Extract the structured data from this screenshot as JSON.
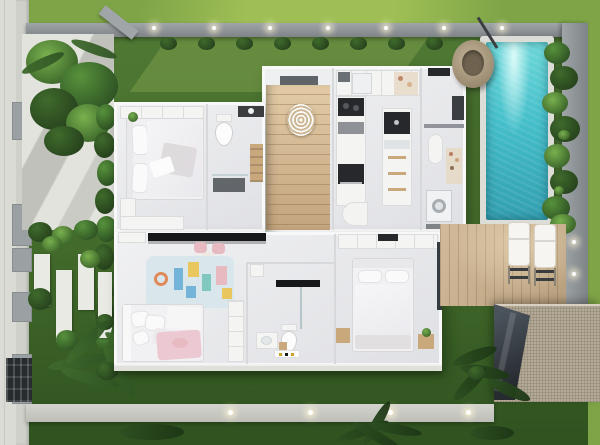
{
  "scene": {
    "type": "architectural-3d-floor-plan-render",
    "view": "top-down",
    "house": {
      "rooms": [
        {
          "name": "bedroom-1",
          "furniture": [
            "double-bed",
            "wardrobe",
            "tv-panel",
            "closet",
            "plant"
          ]
        },
        {
          "name": "ensuite-bathroom",
          "furniture": [
            "toilet",
            "dark-vanity",
            "ladder-shelf",
            "shower-mat",
            "glass-screen"
          ]
        },
        {
          "name": "staircase",
          "furniture": [
            "wood-steps",
            "spiral-pendant-light",
            "entry-door"
          ]
        },
        {
          "name": "kitchen",
          "furniture": [
            "upper-cabinets",
            "fridge",
            "pantry-shelf",
            "cooktop",
            "oven",
            "island-counter",
            "sink",
            "drawers",
            "round-table"
          ]
        },
        {
          "name": "laundry-room",
          "furniture": [
            "counter-rail",
            "capsule-table",
            "bottle-shelf",
            "washing-machine",
            "steel-unit"
          ]
        },
        {
          "name": "living-area",
          "furniture": [
            "media-console",
            "sideboard",
            "kids-chairs",
            "round-side-table"
          ]
        },
        {
          "name": "kids-bedroom",
          "furniture": [
            "play-rug",
            "kids-bed",
            "cabinet",
            "floor-cushion"
          ]
        },
        {
          "name": "bathroom-2",
          "furniture": [
            "rain-shower-bar",
            "glass-screen",
            "toilet",
            "vanity",
            "wood-stool",
            "bath-mat",
            "shelf-box"
          ]
        },
        {
          "name": "master-bedroom",
          "furniture": [
            "double-bed",
            "wardrobe",
            "nightstand-left",
            "nightstand-right",
            "sliding-glass-door"
          ]
        }
      ]
    },
    "outdoor": {
      "features": [
        "street-sidewalk",
        "left-boundary-wall",
        "wall-pillars",
        "driveway-gate",
        "entrance-gate-pillar",
        "concrete-walkway",
        "hedge-row",
        "shrub-row",
        "stepping-stone-slabs",
        "round-bushes",
        "palm-cluster-top-left",
        "palm-bottom-left",
        "lawn",
        "top-perimeter-wall",
        "wall-uplights",
        "swimming-pool",
        "pool-coping",
        "hanging-egg-chair",
        "poolside-bush-hedge",
        "right-boundary-wall",
        "timber-deck",
        "sun-lounger-1",
        "sun-lounger-2",
        "pergola-gravel-roof",
        "dark-glass-screen",
        "rear-path",
        "path-uplights",
        "garden-fronds",
        "grass-tufts"
      ]
    }
  },
  "palette": {
    "grass-bright": "#7ea447",
    "grass-light": "#a3c257",
    "lawn-top": "#4e7833",
    "lawn-mid": "#47702e",
    "lawn-dark": "#3a6026",
    "lawn-deep": "#2f5220",
    "sidewalk": "#dadbd5",
    "wall-panel": "#cfd0ca",
    "pillar-gray": "#9ba1a3",
    "perim-a": "#a0a5a8",
    "perim-b": "#7e8387",
    "concrete": "#e2e3dd",
    "path-a": "#d3d4ce",
    "path-b": "#bcbeb7",
    "slab-white": "#e9eae4",
    "house-floor": "#eaebed",
    "house-wall": "#f8f8f8",
    "wall-line": "#d7d8da",
    "furniture-white": "#f4f4f2",
    "furniture-border": "#dcdcde",
    "bedding-white": "#f1f0f2",
    "pillow-white": "#fafafa",
    "blanket-gray": "#dcd8da",
    "blanket-pink": "#ecc9d2",
    "rug-blue": "#d9e7ec",
    "wood-mid": "#c9a87c",
    "step-line": "rgba(130,95,60,0.35)",
    "appliance-dark": "#26282c",
    "fixture-dark": "#17181a",
    "glass-dark": "#343b41",
    "mat-dark": "#4b5054",
    "steel": "#3b3e41",
    "pool-light": "#6fd8da",
    "pool-mid": "#45bfca",
    "pool-deep": "#339fb0",
    "coping": "#dcddd7",
    "deck-a": "#d2bb9a",
    "deck-b": "#b89f7e",
    "lounger-white": "#f6f5f2",
    "lounger-frame": "#3a3d40",
    "rattan-a": "#c3b49a",
    "rattan-b": "#97876c",
    "bush-dark": "#2f5424",
    "bush-mid": "#3f6a2c",
    "bush-light": "#57923c",
    "bush-bright": "#79b14e",
    "shrub-dark": "#27431d",
    "roof-a": "#b3a996",
    "roof-line": "rgba(90,82,68,0.2)",
    "gate-dark": "#272b2f",
    "accent-pink": "#e7b9c0",
    "accent-blue": "#74b4d8",
    "accent-yellow": "#eac75e",
    "accent-teal": "#80c8c0",
    "accent-orange": "#e08a5a",
    "gold": "#c9a227"
  }
}
